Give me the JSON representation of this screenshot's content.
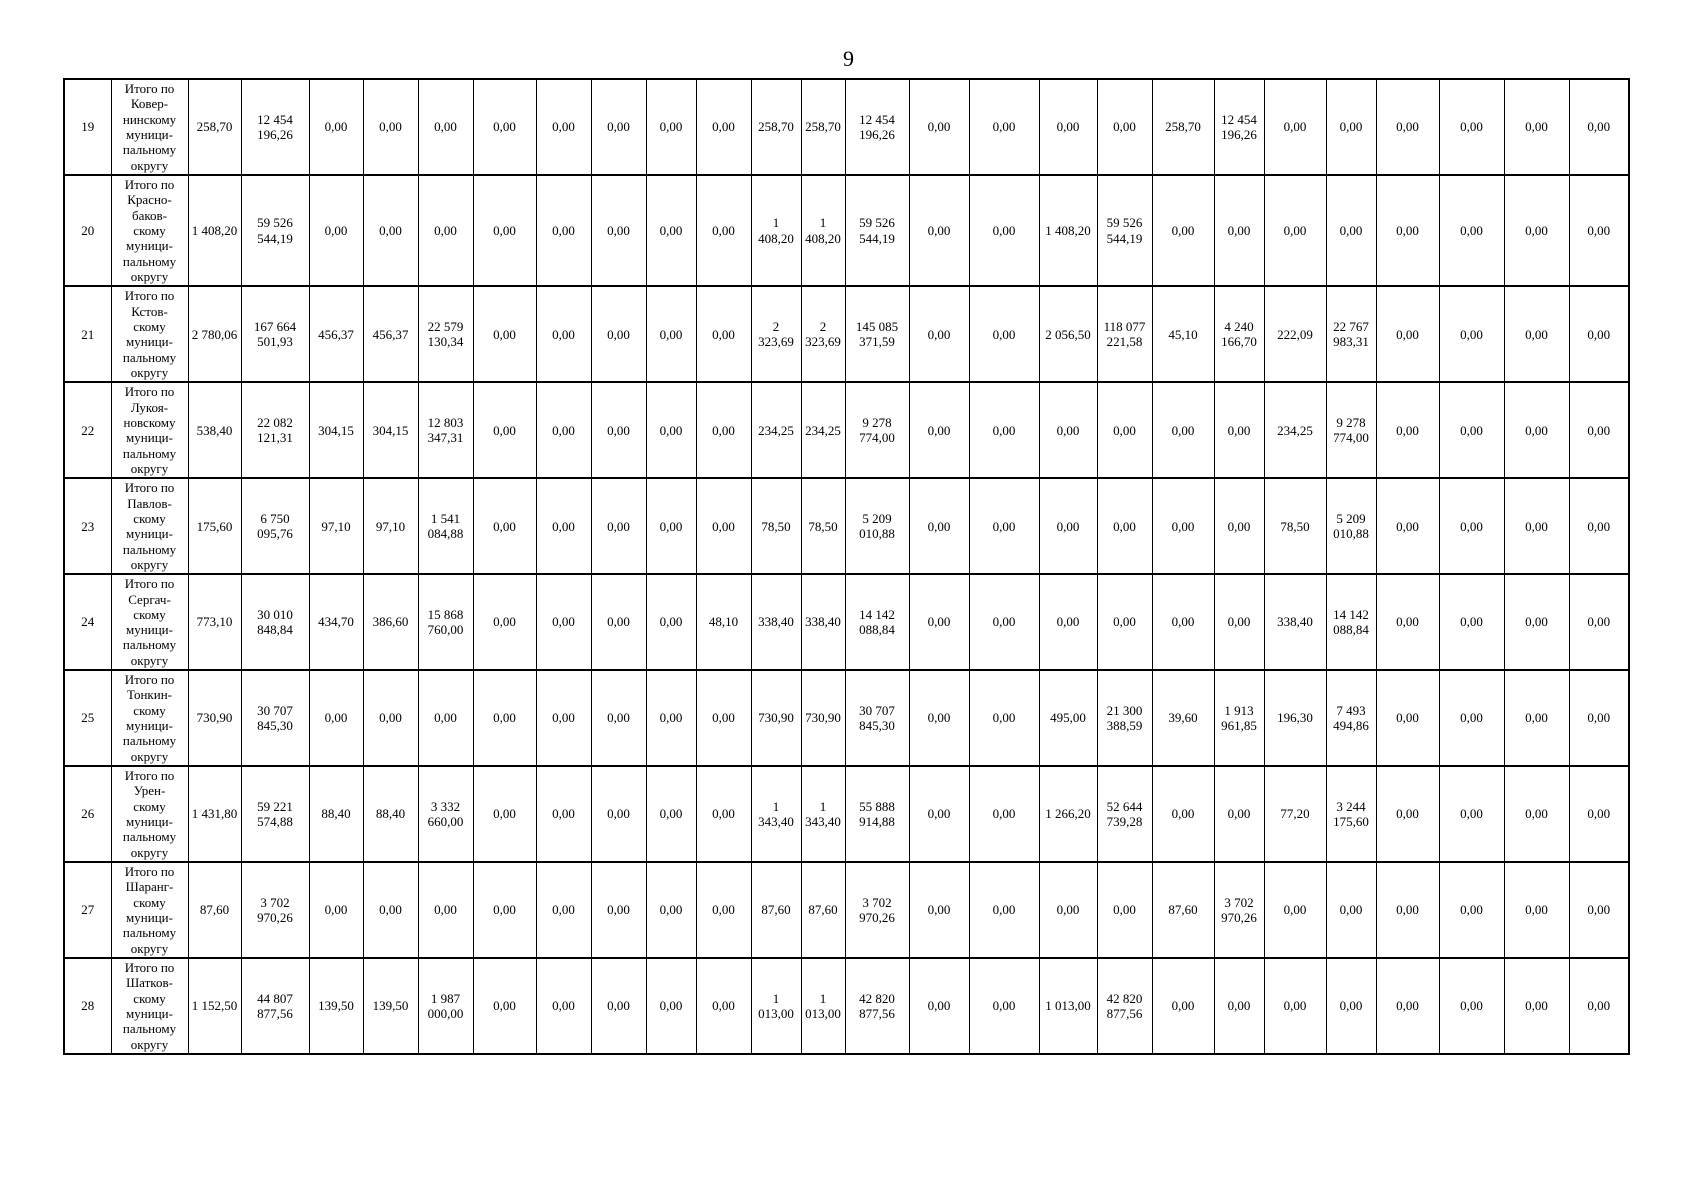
{
  "page": {
    "number": "9"
  },
  "table": {
    "rows": [
      {
        "num": "19",
        "name": "Итого по\nКовер-\nнинскому\nмуници-\nпальному\nокругу",
        "values": [
          "258,70",
          "12 454 196,26",
          "0,00",
          "0,00",
          "0,00",
          "0,00",
          "0,00",
          "0,00",
          "0,00",
          "0,00",
          "258,70",
          "258,70",
          "12 454 196,26",
          "0,00",
          "0,00",
          "0,00",
          "0,00",
          "258,70",
          "12 454 196,26",
          "0,00",
          "0,00",
          "0,00",
          "0,00",
          "0,00",
          "0,00"
        ]
      },
      {
        "num": "20",
        "name": "Итого по\nКрасно-\nбаков-\nскому\nмуници-\nпальному\nокругу",
        "values": [
          "1 408,20",
          "59 526 544,19",
          "0,00",
          "0,00",
          "0,00",
          "0,00",
          "0,00",
          "0,00",
          "0,00",
          "0,00",
          "1 408,20",
          "1 408,20",
          "59 526 544,19",
          "0,00",
          "0,00",
          "1 408,20",
          "59 526 544,19",
          "0,00",
          "0,00",
          "0,00",
          "0,00",
          "0,00",
          "0,00",
          "0,00",
          "0,00"
        ]
      },
      {
        "num": "21",
        "name": "Итого по\nКстов-\nскому\nмуници-\nпальному\nокругу",
        "values": [
          "2 780,06",
          "167 664 501,93",
          "456,37",
          "456,37",
          "22 579 130,34",
          "0,00",
          "0,00",
          "0,00",
          "0,00",
          "0,00",
          "2 323,69",
          "2 323,69",
          "145 085 371,59",
          "0,00",
          "0,00",
          "2 056,50",
          "118 077 221,58",
          "45,10",
          "4 240 166,70",
          "222,09",
          "22 767 983,31",
          "0,00",
          "0,00",
          "0,00",
          "0,00"
        ]
      },
      {
        "num": "22",
        "name": "Итого по\nЛукоя-\nновскому\nмуници-\nпальному\nокругу",
        "values": [
          "538,40",
          "22 082 121,31",
          "304,15",
          "304,15",
          "12 803 347,31",
          "0,00",
          "0,00",
          "0,00",
          "0,00",
          "0,00",
          "234,25",
          "234,25",
          "9 278 774,00",
          "0,00",
          "0,00",
          "0,00",
          "0,00",
          "0,00",
          "0,00",
          "234,25",
          "9 278 774,00",
          "0,00",
          "0,00",
          "0,00",
          "0,00"
        ]
      },
      {
        "num": "23",
        "name": "Итого по\nПавлов-\nскому\nмуници-\nпальному\nокругу",
        "values": [
          "175,60",
          "6 750 095,76",
          "97,10",
          "97,10",
          "1 541 084,88",
          "0,00",
          "0,00",
          "0,00",
          "0,00",
          "0,00",
          "78,50",
          "78,50",
          "5 209 010,88",
          "0,00",
          "0,00",
          "0,00",
          "0,00",
          "0,00",
          "0,00",
          "78,50",
          "5 209 010,88",
          "0,00",
          "0,00",
          "0,00",
          "0,00"
        ]
      },
      {
        "num": "24",
        "name": "Итого по\nСергач-\nскому\nмуници-\nпальному\nокругу",
        "values": [
          "773,10",
          "30 010 848,84",
          "434,70",
          "386,60",
          "15 868 760,00",
          "0,00",
          "0,00",
          "0,00",
          "0,00",
          "48,10",
          "338,40",
          "338,40",
          "14 142 088,84",
          "0,00",
          "0,00",
          "0,00",
          "0,00",
          "0,00",
          "0,00",
          "338,40",
          "14 142 088,84",
          "0,00",
          "0,00",
          "0,00",
          "0,00"
        ]
      },
      {
        "num": "25",
        "name": "Итого по\nТонкин-\nскому\nмуници-\nпальному\nокругу",
        "values": [
          "730,90",
          "30 707 845,30",
          "0,00",
          "0,00",
          "0,00",
          "0,00",
          "0,00",
          "0,00",
          "0,00",
          "0,00",
          "730,90",
          "730,90",
          "30 707 845,30",
          "0,00",
          "0,00",
          "495,00",
          "21 300 388,59",
          "39,60",
          "1 913 961,85",
          "196,30",
          "7 493 494,86",
          "0,00",
          "0,00",
          "0,00",
          "0,00"
        ]
      },
      {
        "num": "26",
        "name": "Итого по\nУрен-\nскому\nмуници-\nпальному\nокругу",
        "values": [
          "1 431,80",
          "59 221 574,88",
          "88,40",
          "88,40",
          "3 332 660,00",
          "0,00",
          "0,00",
          "0,00",
          "0,00",
          "0,00",
          "1 343,40",
          "1 343,40",
          "55 888 914,88",
          "0,00",
          "0,00",
          "1 266,20",
          "52 644 739,28",
          "0,00",
          "0,00",
          "77,20",
          "3 244 175,60",
          "0,00",
          "0,00",
          "0,00",
          "0,00"
        ]
      },
      {
        "num": "27",
        "name": "Итого по\nШаранг-\nскому\nмуници-\nпальному\nокругу",
        "values": [
          "87,60",
          "3 702 970,26",
          "0,00",
          "0,00",
          "0,00",
          "0,00",
          "0,00",
          "0,00",
          "0,00",
          "0,00",
          "87,60",
          "87,60",
          "3 702 970,26",
          "0,00",
          "0,00",
          "0,00",
          "0,00",
          "87,60",
          "3 702 970,26",
          "0,00",
          "0,00",
          "0,00",
          "0,00",
          "0,00",
          "0,00"
        ]
      },
      {
        "num": "28",
        "name": "Итого по\nШатков-\nскому\nмуници-\nпальному\nокругу",
        "values": [
          "1 152,50",
          "44 807 877,56",
          "139,50",
          "139,50",
          "1 987 000,00",
          "0,00",
          "0,00",
          "0,00",
          "0,00",
          "0,00",
          "1 013,00",
          "1 013,00",
          "42 820 877,56",
          "0,00",
          "0,00",
          "1 013,00",
          "42 820 877,56",
          "0,00",
          "0,00",
          "0,00",
          "0,00",
          "0,00",
          "0,00",
          "0,00",
          "0,00"
        ]
      }
    ]
  }
}
